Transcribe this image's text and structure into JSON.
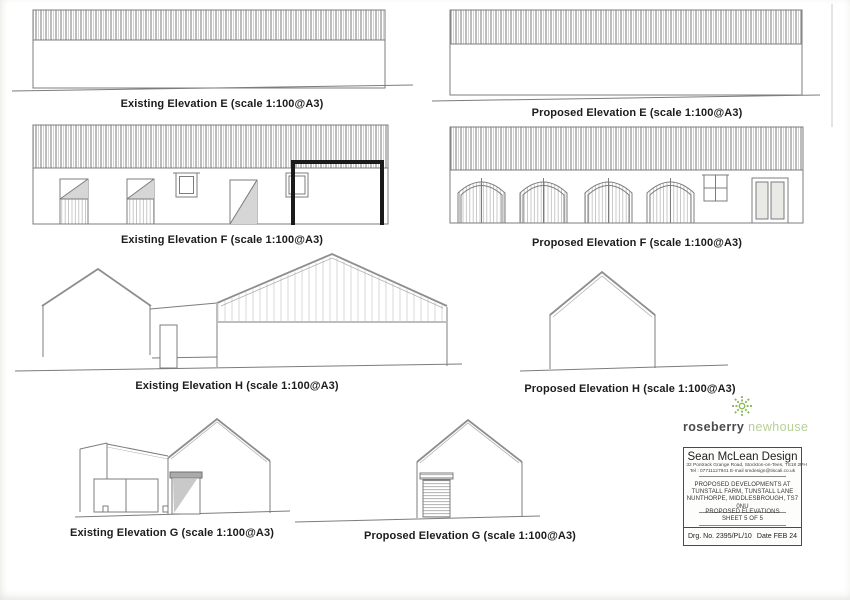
{
  "document": {
    "type": "architectural elevation drawings sheet",
    "line_color": "#7c7c7c",
    "highlight_frame_color": "#1a1a1a",
    "paper_color": "#ffffff"
  },
  "elevations": [
    {
      "id": "existing-e",
      "label": "Existing Elevation E (scale 1:100@A3)"
    },
    {
      "id": "proposed-e",
      "label": "Proposed Elevation E (scale 1:100@A3)"
    },
    {
      "id": "existing-f",
      "label": "Existing Elevation F (scale 1:100@A3)"
    },
    {
      "id": "proposed-f",
      "label": "Proposed Elevation F (scale 1:100@A3)"
    },
    {
      "id": "existing-h",
      "label": "Existing Elevation H (scale 1:100@A3)"
    },
    {
      "id": "proposed-h",
      "label": "Proposed Elevation H (scale 1:100@A3)"
    },
    {
      "id": "existing-g",
      "label": "Existing Elevation G (scale 1:100@A3)"
    },
    {
      "id": "proposed-g",
      "label": "Proposed Elevation G (scale 1:100@A3)"
    }
  ],
  "logo": {
    "brand_primary": "roseberry",
    "brand_secondary": "newhouse",
    "icon": "flower-burst",
    "icon_color": "#8bb757",
    "primary_color": "#4b4b4d",
    "secondary_color": "#b8cf95"
  },
  "title_block": {
    "company": "Sean McLean Design",
    "address": "32 Pontrack Grange Road, Stockton-on-Tees, TS18 2PH",
    "contact": "Tel : 07711127941   E-mail smdesign@tiscali.co.uk",
    "project_lines": [
      "PROPOSED DEVELOPMENTS AT",
      "TUNSTALL FARM, TUNSTALL LANE",
      "NUNTHORPE, MIDDLESBROUGH, TS7 0NU"
    ],
    "drawing_title": "PROPOSED ELEVATIONS",
    "sheet": "SHEET 5 OF 5",
    "drg_label": "Drg. No.",
    "drg_no": "2395/PL/10",
    "date_label": "Date",
    "date_value": "FEB 24"
  }
}
